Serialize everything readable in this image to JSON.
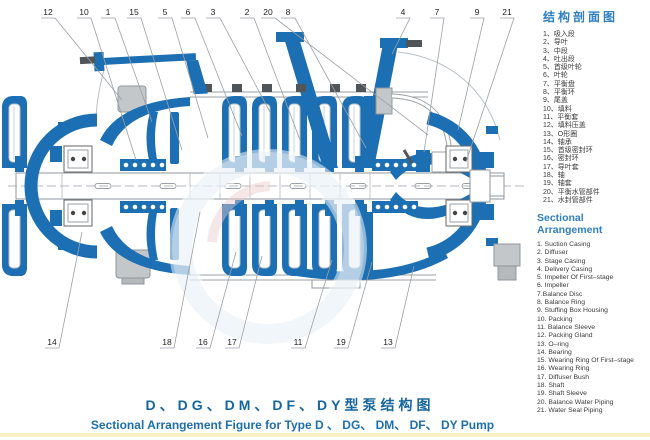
{
  "legend_cn": {
    "title": "结构剖面图",
    "items": [
      "1、吸入段",
      "2、导叶",
      "3、中段",
      "4、吐出段",
      "5、首级叶轮",
      "6、叶轮",
      "7、平衡盘",
      "8、平衡环",
      "9、尾盖",
      "10、填料",
      "11、平衡套",
      "12、填料压盖",
      "13、O形圈",
      "14、轴承",
      "15、首级密封环",
      "16、密封环",
      "17、导叶套",
      "18、轴",
      "19、轴套",
      "20、平衡水管部件",
      "21、水封管部件"
    ]
  },
  "legend_en": {
    "title": "Sectional Arrangement",
    "items": [
      "1. Suction Casing",
      "2. Diffuser",
      "3. Stage Casing",
      "4. Delivery Casing",
      "5. Impeller Of First–stage",
      "6. Impeller",
      "7.Balance Disc",
      "8. Balance Ring",
      "9. Stuffing Box Housing",
      "10. Packing",
      "11. Balance Sleeve",
      "12. Packing Gland",
      "13. O–ring",
      "14. Bearing",
      "15. Wearing Ring Of First–stage",
      "16. Wearing Ring",
      "17. Diffuser Bush",
      "18. Shaft",
      "19. Shaft Sleeve",
      "20. Balance Water Piping",
      "21. Water Seal Piping"
    ]
  },
  "caption_cn": "D、DG、DM、DF、DY型泵结构图",
  "caption_en": "Sectional Arrangement Figure for Type D 、 DG、 DM、 DF、 DY Pump",
  "diagram": {
    "callouts_top": [
      {
        "n": "12",
        "x": 48,
        "tx": 122,
        "ty": 100
      },
      {
        "n": "10",
        "x": 84,
        "tx": 136,
        "ty": 160
      },
      {
        "n": "1",
        "x": 108,
        "tx": 152,
        "ty": 122
      },
      {
        "n": "15",
        "x": 134,
        "tx": 182,
        "ty": 150
      },
      {
        "n": "5",
        "x": 165,
        "tx": 208,
        "ty": 138
      },
      {
        "n": "6",
        "x": 188,
        "tx": 242,
        "ty": 136
      },
      {
        "n": "3",
        "x": 213,
        "tx": 270,
        "ty": 112
      },
      {
        "n": "2",
        "x": 247,
        "tx": 300,
        "ty": 140
      },
      {
        "n": "20",
        "x": 268,
        "tx": 428,
        "ty": 135
      },
      {
        "n": "8",
        "x": 288,
        "tx": 366,
        "ty": 148
      },
      {
        "n": "4",
        "x": 403,
        "tx": 392,
        "ty": 54
      },
      {
        "n": "7",
        "x": 437,
        "tx": 424,
        "ty": 152
      },
      {
        "n": "9",
        "x": 477,
        "tx": 458,
        "ty": 130
      },
      {
        "n": "21",
        "x": 507,
        "tx": 466,
        "ty": 162
      }
    ],
    "callouts_bottom": [
      {
        "n": "14",
        "x": 52,
        "tx": 82,
        "ty": 232
      },
      {
        "n": "18",
        "x": 167,
        "tx": 200,
        "ty": 212
      },
      {
        "n": "16",
        "x": 203,
        "tx": 236,
        "ty": 252
      },
      {
        "n": "17",
        "x": 232,
        "tx": 262,
        "ty": 256
      },
      {
        "n": "11",
        "x": 298,
        "tx": 332,
        "ty": 260
      },
      {
        "n": "19",
        "x": 341,
        "tx": 372,
        "ty": 262
      },
      {
        "n": "13",
        "x": 388,
        "tx": 414,
        "ty": 266
      }
    ],
    "colors": {
      "pump_blue": "#1c6fb2",
      "line_gray": "#9aa0a6",
      "metal_gray": "#c4c7ca",
      "nut_dark": "#50555a",
      "legend_blue": "#2f7fc1",
      "caption_blue": "#16669e",
      "strip_yellow": "#f5f0c6",
      "watermark_blue": "#dfecf5"
    }
  }
}
